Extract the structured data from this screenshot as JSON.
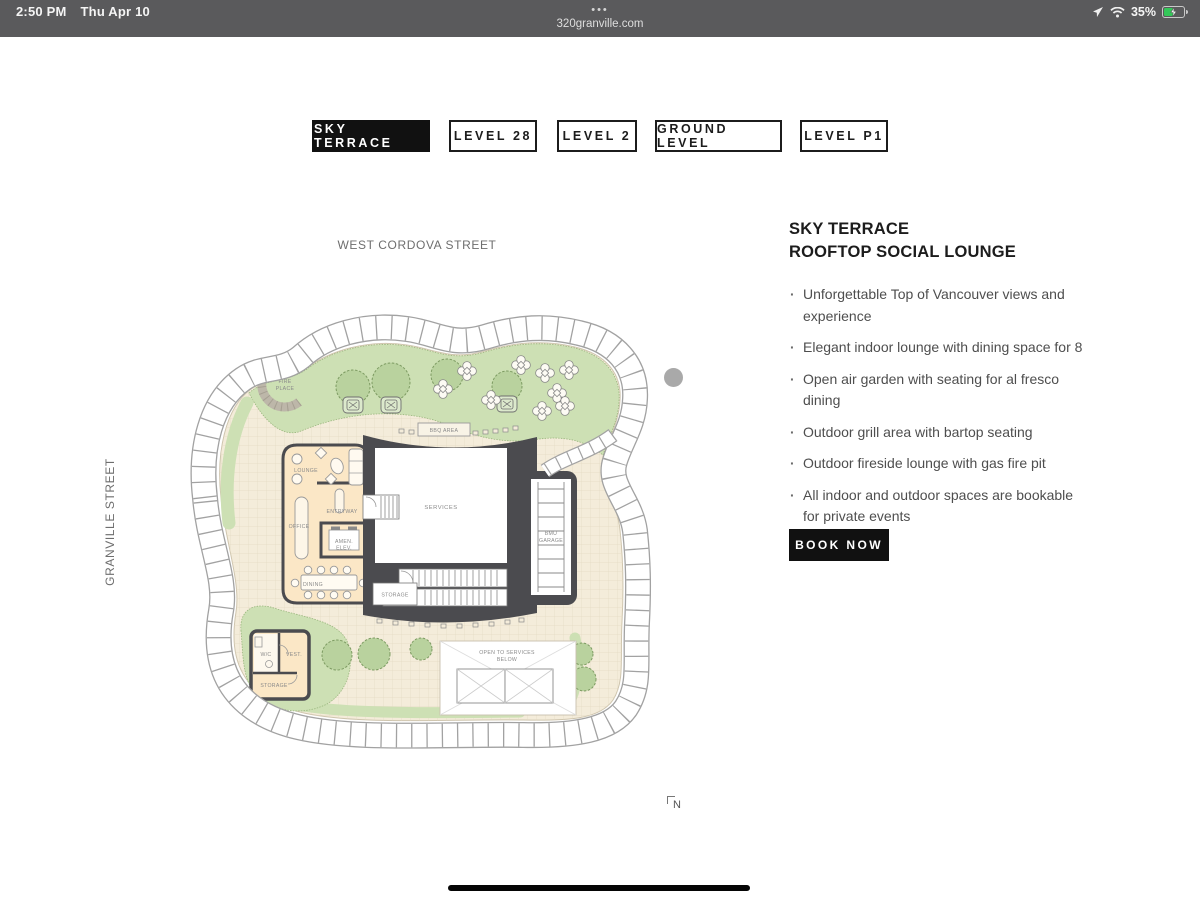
{
  "status_bar": {
    "time": "2:50 PM",
    "date": "Thu Apr 10",
    "dots": "•••",
    "url": "320granville.com",
    "battery_percent": "35%",
    "icons": [
      "location-icon",
      "wifi-icon",
      "battery-charging-icon"
    ]
  },
  "tabs": [
    {
      "label": "SKY TERRACE",
      "active": true
    },
    {
      "label": "LEVEL 28",
      "active": false
    },
    {
      "label": "LEVEL 2",
      "active": false
    },
    {
      "label": "GROUND LEVEL",
      "active": false
    },
    {
      "label": "LEVEL P1",
      "active": false
    }
  ],
  "plan": {
    "street_top": "WEST CORDOVA STREET",
    "street_left": "GRANVILLE STREET",
    "north_label": "N",
    "labels": {
      "fire1": "FIRE",
      "fire2": "PLACE",
      "bbq": "BBQ AREA",
      "lounge": "LOUNGE",
      "entryway": "ENTRYWAY",
      "office": "OFFICE",
      "amen1": "AMEN.",
      "amen2": "ELEV.",
      "services": "SERVICES",
      "bmu1": "BMU",
      "bmu2": "GARAGE",
      "dining": "DINING",
      "storage_core": "STORAGE",
      "wc": "W/C",
      "vest": "VEST.",
      "storage_wc": "STORAGE",
      "open1": "OPEN TO SERVICES",
      "open2": "BELOW"
    }
  },
  "details": {
    "title_line1": "SKY TERRACE",
    "title_line2": "ROOFTOP SOCIAL LOUNGE",
    "bullets": [
      "Unforgettable Top of Vancouver views and experience",
      "Elegant indoor lounge with dining space for 8",
      "Open air garden with seating for al fresco dining",
      "Outdoor grill area with bartop seating",
      "Outdoor fireside lounge with gas fire pit",
      "All indoor and outdoor spaces are bookable for private events"
    ],
    "cta": "BOOK NOW"
  },
  "colors": {
    "tab_active_bg": "#111111",
    "cta_bg": "#111111",
    "terrace": "#f4ecda",
    "landscape": "#cde0b4",
    "building_core": "#4b4b4f",
    "indoor_room": "#fbe7c6",
    "statusbar_bg": "#5a5a5c"
  }
}
